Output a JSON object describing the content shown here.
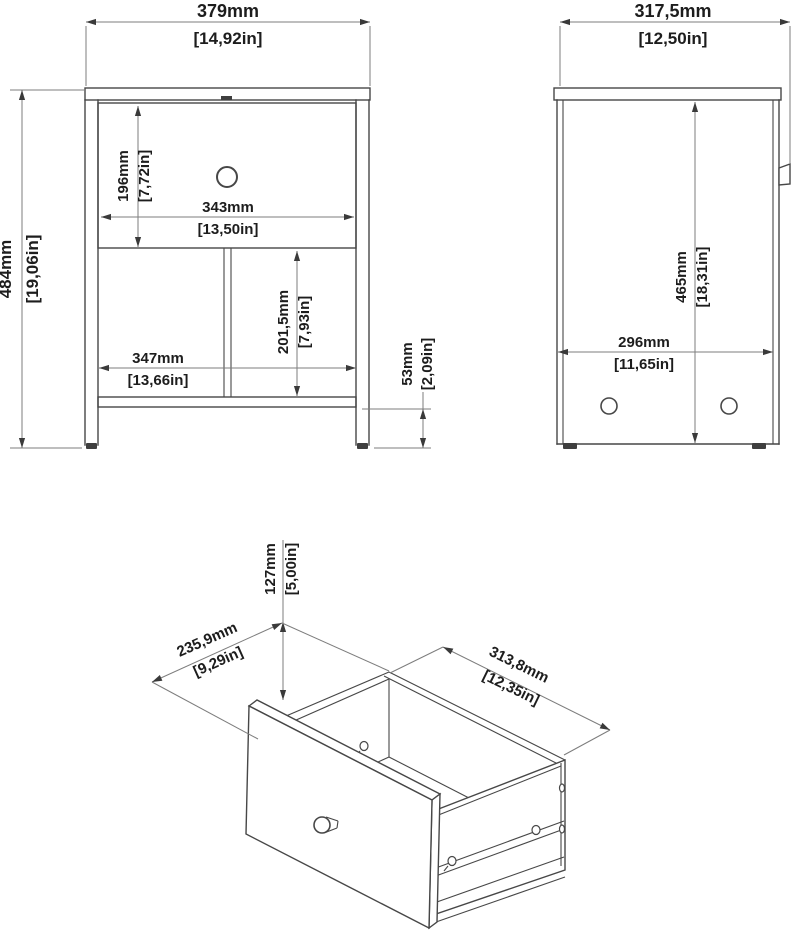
{
  "title": "Nightstand technical drawing with dimensions",
  "colors": {
    "background": "#ffffff",
    "object_line": "#474747",
    "dimension_line": "#7d7d7d",
    "text": "#1d1d1d"
  },
  "front_view": {
    "overall_width": {
      "mm": "379mm",
      "in": "[14,92in]"
    },
    "overall_height": {
      "mm": "484mm",
      "in": "[19,06in]"
    },
    "drawer_front_height": {
      "mm": "196mm",
      "in": "[7,72in]"
    },
    "drawer_front_width": {
      "mm": "343mm",
      "in": "[13,50in]"
    },
    "shelf_width": {
      "mm": "347mm",
      "in": "[13,66in]"
    },
    "compartment_height": {
      "mm": "201,5mm",
      "in": "[7,93in]"
    },
    "base_clearance": {
      "mm": "53mm",
      "in": "[2,09in]"
    }
  },
  "side_view": {
    "overall_depth": {
      "mm": "317,5mm",
      "in": "[12,50in]"
    },
    "side_panel_height": {
      "mm": "465mm",
      "in": "[18,31in]"
    },
    "side_panel_depth": {
      "mm": "296mm",
      "in": "[11,65in]"
    }
  },
  "drawer_view": {
    "drawer_height": {
      "mm": "127mm",
      "in": "[5,00in]"
    },
    "drawer_depth": {
      "mm": "235,9mm",
      "in": "[9,29in]"
    },
    "drawer_width": {
      "mm": "313,8mm",
      "in": "[12,35in]"
    }
  }
}
